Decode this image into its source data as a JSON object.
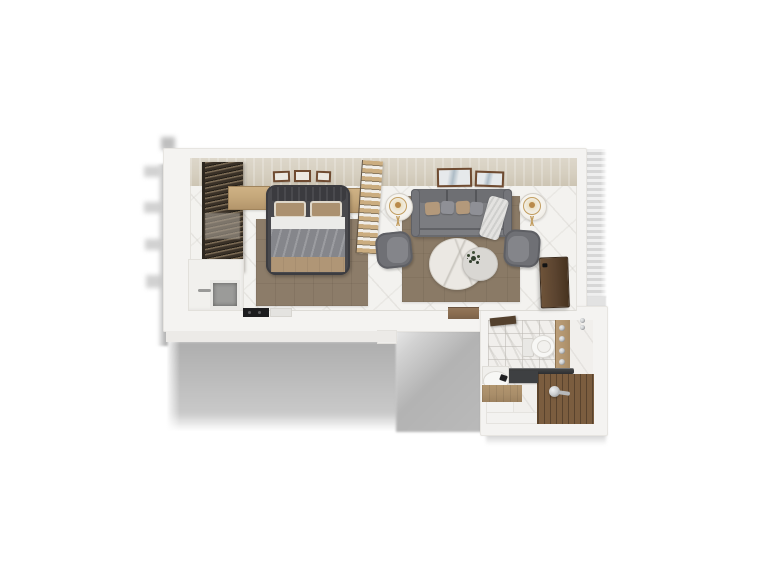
{
  "scene": {
    "type": "3d-floorplan-render",
    "description": "Top-down 3D render of a one-bedroom apartment floor plan on a white background with soft cast shadows",
    "rooms": [
      {
        "name": "bedroom",
        "furniture": [
          "wardrobe-curtain-unit",
          "double-bed",
          "bed-pillows",
          "bed-blanket",
          "headboard-cabinet-left",
          "headboard-cabinet-right",
          "area-rug",
          "wall-frames-x3",
          "slatted-room-divider"
        ]
      },
      {
        "name": "living-room",
        "furniture": [
          "three-seat-sofa",
          "throw-pillows",
          "throw-blanket",
          "side-table-with-lamp-left",
          "side-table-with-lamp-right",
          "armchair-left",
          "armchair-right",
          "round-marble-coffee-table",
          "nesting-side-table-with-plant",
          "area-rug",
          "wall-frames-x2",
          "entry-door-leaf",
          "doorway-threshold"
        ]
      },
      {
        "name": "kitchenette",
        "furniture": [
          "counter-block",
          "sink-basin",
          "faucet",
          "cooktop",
          "appliance-front"
        ]
      },
      {
        "name": "bathroom",
        "furniture": [
          "door-leaf",
          "toilet",
          "shower-fixture-panel",
          "glass-partition",
          "wood-shower-floor",
          "shower-handle",
          "dark-counter",
          "vanity-sink",
          "vanity-wood-counter",
          "wall-accessories"
        ]
      }
    ],
    "shadows": [
      "bottom-cast-shadow",
      "corridor-cast-shadow",
      "left-wall-shadow-streaks",
      "right-striped-shadow",
      "bathroom-bottom-shadow"
    ]
  },
  "colors": {
    "bg": "#ffffff",
    "wall": "#f4f3f1",
    "wallEdge": "#e7e5e1",
    "wallFaceTop": "#d6cfc0",
    "floor": "#f3f2ef",
    "tile": "#f1efec",
    "rugBedroom": "#8c7c69",
    "rugLiving": "#8a7a66",
    "wardrobeDark": "#3a3127",
    "wardrobeLight": "#7b6b55",
    "sheer": "#a29a8f",
    "cabinetWood": "#c5a87b",
    "bedFrame": "#49494d",
    "headboard": "#3b3b3f",
    "pillowTan": "#ab9170",
    "pillowEdge": "#ded7c9",
    "sheet": "#ebebe9",
    "blanket": "#85868b",
    "bedFoot": "#b09676",
    "partitionWood": "#cbad80",
    "sofa": "#7c7d81",
    "sofaBack": "#6e6f73",
    "sofaArm": "#74757a",
    "pillowGray": "#8f9096",
    "blanketThrow": "#e3e2e0",
    "tableWhite": "#f3f1ec",
    "gold": "#c19c5e",
    "lampGlow": "#b98a4a",
    "chair": "#6f7075",
    "chairSeat": "#84858a",
    "marbleTable": "#ebe8e3",
    "smallTable": "#d9d7d3",
    "plant": "#33402e",
    "frameWood": "#6f4b31",
    "frameArt": "#aebcc6",
    "doorWood": "#5a432f",
    "threshold": "#8a6d50",
    "showerWood": "#7b5d3f",
    "fixturePanel": "#b2956f",
    "vanityWood": "#a98e6a",
    "porcelain": "#f7f7f5",
    "counterDark": "#3e4042",
    "chrome": "#c9cbcd",
    "sinkGray": "#9b9b99",
    "cooktop": "#1d1d1f",
    "shadow": "#aeaeae",
    "shadowSoft": "#c9c9c9",
    "corridorShadow": "#b3b3b3",
    "stripeLight": "#efefef",
    "stripeDark": "#d6d6d6"
  }
}
